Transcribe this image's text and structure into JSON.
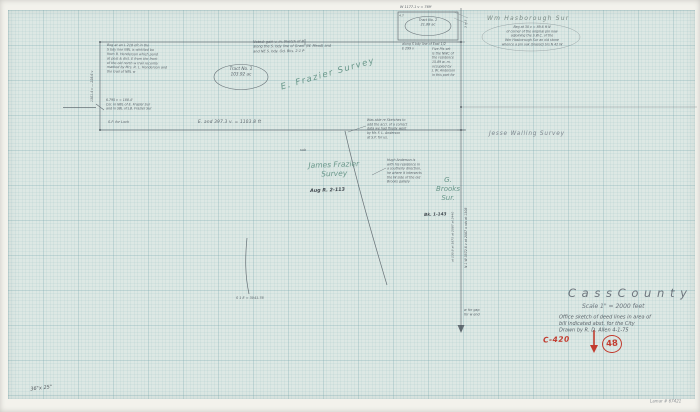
{
  "title_block": {
    "county": "C a s s     C o u n t y",
    "scale": "Scale        1\" = 2000 feet",
    "office_note": "Office sketch of deed lines in area of\nbill indicated abst. for the City\nDrawn by R. D. Allen   4-1-75",
    "file_no": "C-420",
    "stamp_no": "48"
  },
  "footer": {
    "sheet_size": "36\"x 25\"",
    "scan_ref": "Lamar # 67421"
  },
  "surveys": {
    "e_frazier": "E.  Frazier  Survey",
    "james_frazier": "James  Frazier\nSurvey",
    "james_frazier_ref": "Aug R. 2-113",
    "g_brooks": "G.\nBrooks\nSur.",
    "g_brooks_ref": "Bk. 1-143",
    "jesse_walling": "Jesse Walling   Survey",
    "wm_hasborough": "Wm  Hasborough   Sur"
  },
  "tracts": {
    "tract1": "Tract  No. 1\n103.92 ac",
    "tract2": "Tract No. 2\n21.88 ac"
  },
  "measurements": {
    "south_line": "E. and    397.3 v.  =  1103.8 ft",
    "west_line_vertical": "1301.4 v  —  228.6 v",
    "tract2_top": "W   1177.1 v  =  769'",
    "tract2_corner": "4.7",
    "tract2_bottom": "along S bdy line of East 1/2\nE    299 v",
    "east_line_vertical_right": "N 1 W  3572.6 v     at 2087 x rds     at 1308",
    "east_line_vertical_left": "at 130.8    at 1875    at 2087    at 2440",
    "sp_line": "S 1 E  =  3041.76",
    "top_cross": "3 in 3"
  },
  "notes": {
    "beg_note": "Beg at an L 218 eft in the\nS bdy line NBL is whittled bo\nfrom R. Henderson which pond\nat post & dist. E from the front\nof the old north w trail recently\nmarked by Mrs. R. L. Henderson and\nthe trail of NBL w",
    "corner_note": "6.795 v = 188.4'\nCor. in NBL of E. Frazier Sur\nand in SBL of J.B. Frazier Sur",
    "sp_lock": "S.P.  for  Lock",
    "noted_note": "Noted:     gain v. in.     Sketch of B\nalong the S. bdy line of Grant (W. Mead) and\nand NE S. bdy.  Od. Bks.  2-1 P",
    "five_pts": "Five Pts set\nis the NWC of\nthe residence\n15.89 w. m.\noccupied by\nJ. W. Anderson\nin this part for",
    "oval_note": "Beg at 30 v = 89.6 ft N\nof corner of the original pin now\nadjoining the S.W.C. of the\nWm Hasborough Sur an old stone\nwhence a pin oak (blazed) brs N 42 W",
    "sketches_note": "Was able re Sketches to\nadd the accr. of a correct\ndata we had finally went\nby Mr. F. L. Anderson\nat S.P. for us.",
    "hugh_note": "Hugh Anderson is\nwith his residence in\na southerly direction,\nhe where it intersects\nthe W side of the old\nBrooks gallery",
    "gap_note": "w for gap\nfor w end",
    "sub": "sub"
  }
}
